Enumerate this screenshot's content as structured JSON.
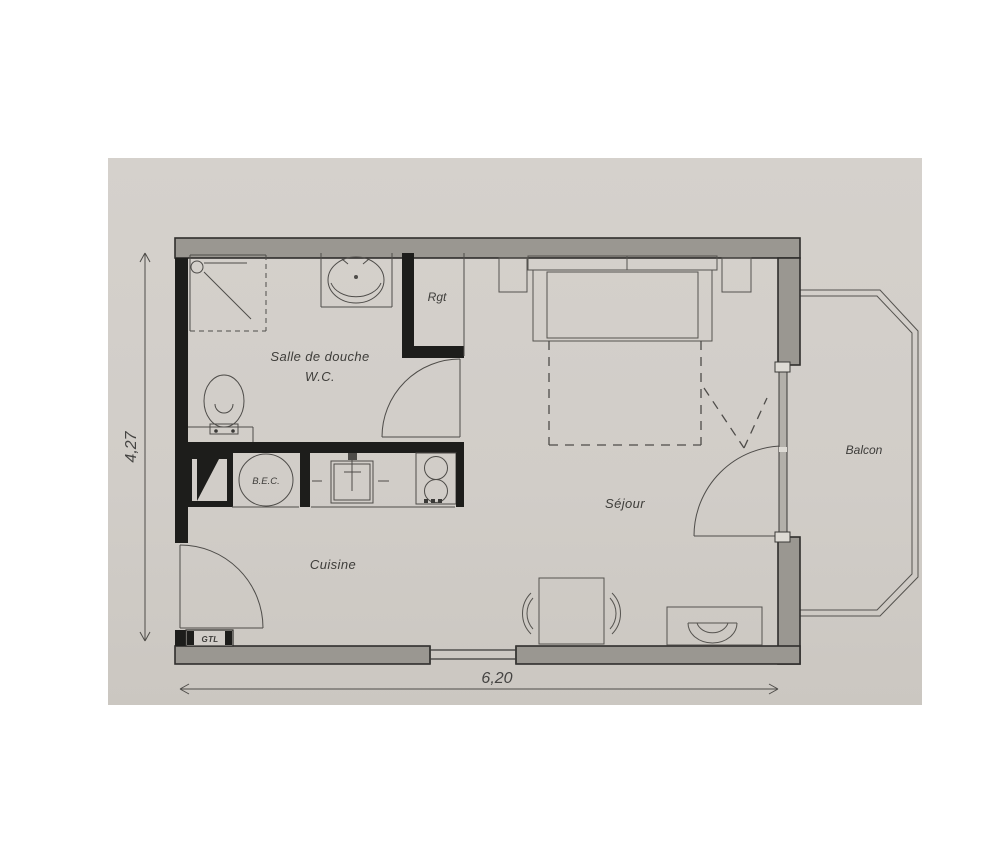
{
  "floorplan": {
    "rooms": {
      "bathroom_line1": "Salle de douche",
      "bathroom_line2": "W.C.",
      "storage": "Rgt",
      "living": "Séjour",
      "kitchen": "Cuisine",
      "balcony": "Balcon"
    },
    "equipment": {
      "water_heater": "B.E.C.",
      "utility_box": "GTL"
    },
    "dimensions": {
      "width_m": "6,20",
      "height_m": "4,27"
    },
    "colors": {
      "page_background": "#ffffff",
      "paper": "#d2cec9",
      "exterior_wall": "#9a9791",
      "interior_wall": "#1d1d1b",
      "line": "#4e4c49"
    }
  }
}
